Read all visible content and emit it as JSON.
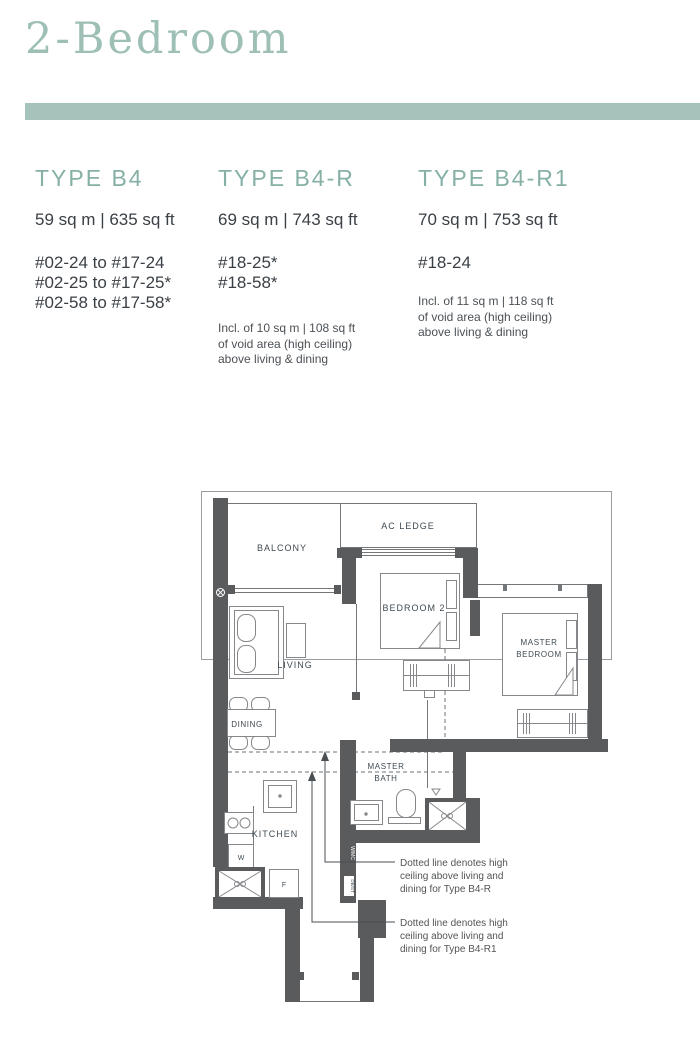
{
  "page": {
    "title": "2-Bedroom"
  },
  "colors": {
    "accent_bar": "#a5c3bb",
    "heading_teal": "#86b0a6",
    "wall": "#595b5d",
    "body_text": "#3a4046"
  },
  "types": [
    {
      "name": "TYPE B4",
      "area": "59 sq m | 635 sq ft",
      "units": [
        "#02-24 to #17-24",
        "#02-25 to #17-25*",
        "#02-58 to #17-58*"
      ],
      "note_lines": []
    },
    {
      "name": "TYPE B4-R",
      "area": "69 sq m | 743 sq ft",
      "units": [
        "#18-25*",
        "#18-58*"
      ],
      "note_lines": [
        "Incl. of 10 sq m | 108 sq ft",
        "of void area (high ceiling)",
        "above living & dining"
      ]
    },
    {
      "name": "TYPE B4-R1",
      "area": "70 sq m | 753 sq ft",
      "units": [
        "#18-24"
      ],
      "note_lines": [
        "Incl. of 11 sq m | 118 sq ft",
        "of void area (high ceiling)",
        "above living & dining"
      ]
    }
  ],
  "floorplan": {
    "room_labels": {
      "balcony": "BALCONY",
      "ac_ledge": "AC LEDGE",
      "bedroom2": "BEDROOM 2",
      "master1": "MASTER",
      "master2": "BEDROOM",
      "living": "LIVING",
      "dining": "DINING",
      "bath1": "MASTER",
      "bath2": "BATH",
      "kitchen": "KITCHEN",
      "washer": "W",
      "fridge": "F",
      "riser_top": "W/MC",
      "riser_bottom": "DB/ST"
    },
    "annotation1_lines": [
      "Dotted line denotes high",
      "ceiling above living and",
      "dining for Type B4-R"
    ],
    "annotation2_lines": [
      "Dotted line denotes high",
      "ceiling above living and",
      "dining for Type B4-R1"
    ]
  }
}
